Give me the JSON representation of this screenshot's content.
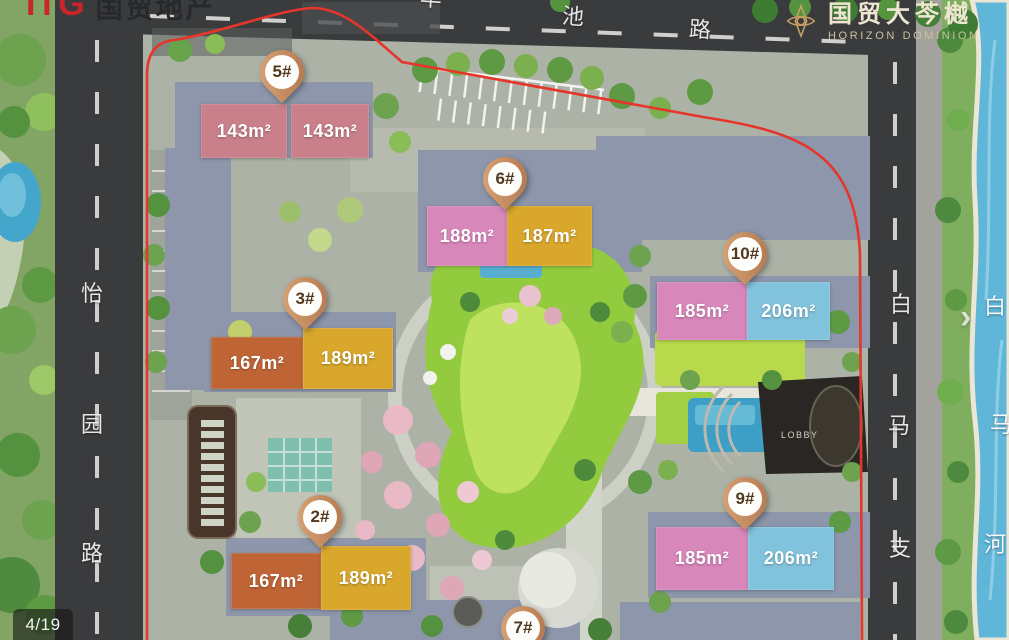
{
  "header": {
    "developer_logo": {
      "itg": "ITG",
      "cn": "国贸地产"
    },
    "project_logo": {
      "cn": "国贸大芩樾",
      "en": "HORIZON DOMINION"
    }
  },
  "roads": {
    "top_partial": "丰",
    "top": [
      "池",
      "路"
    ],
    "left": [
      "怡",
      "园",
      "路"
    ],
    "right": [
      "白",
      "马",
      "支"
    ],
    "river": [
      "白",
      "马",
      "河"
    ]
  },
  "site": {
    "lobby": "LOBBY",
    "buildings": [
      {
        "id": "5#",
        "units": [
          {
            "area": "143m²"
          },
          {
            "area": "143m²"
          }
        ]
      },
      {
        "id": "6#",
        "units": [
          {
            "area": "188m²"
          },
          {
            "area": "187m²"
          }
        ]
      },
      {
        "id": "3#",
        "units": [
          {
            "area": "167m²"
          },
          {
            "area": "189m²"
          }
        ]
      },
      {
        "id": "10#",
        "units": [
          {
            "area": "185m²"
          },
          {
            "area": "206m²"
          }
        ]
      },
      {
        "id": "2#",
        "units": [
          {
            "area": "167m²"
          },
          {
            "area": "189m²"
          }
        ]
      },
      {
        "id": "9#",
        "units": [
          {
            "area": "185m²"
          },
          {
            "area": "206m²"
          }
        ]
      },
      {
        "id": "7#",
        "units": []
      }
    ]
  },
  "viewer": {
    "counter": "4/19"
  },
  "icons": {
    "next-arrow": "›",
    "project-emblem": "❖"
  },
  "colors": {
    "rose": "#c9808b",
    "pink": "#d887bb",
    "gold": "#d8a72c",
    "orange": "#bf6535",
    "blue": "#81c3dc",
    "road": "#3a3b3d",
    "road-line": "#d2d2d2",
    "plate": "#8d96aa",
    "water": "#5fb6d8",
    "boundary-red": "#e6352b",
    "pin-copper-light": "#dca87c",
    "pin-copper-dark": "#b0734a",
    "pin-text": "#53381d",
    "logo-red": "#c9252c",
    "logo-gold": "#c9a063"
  }
}
